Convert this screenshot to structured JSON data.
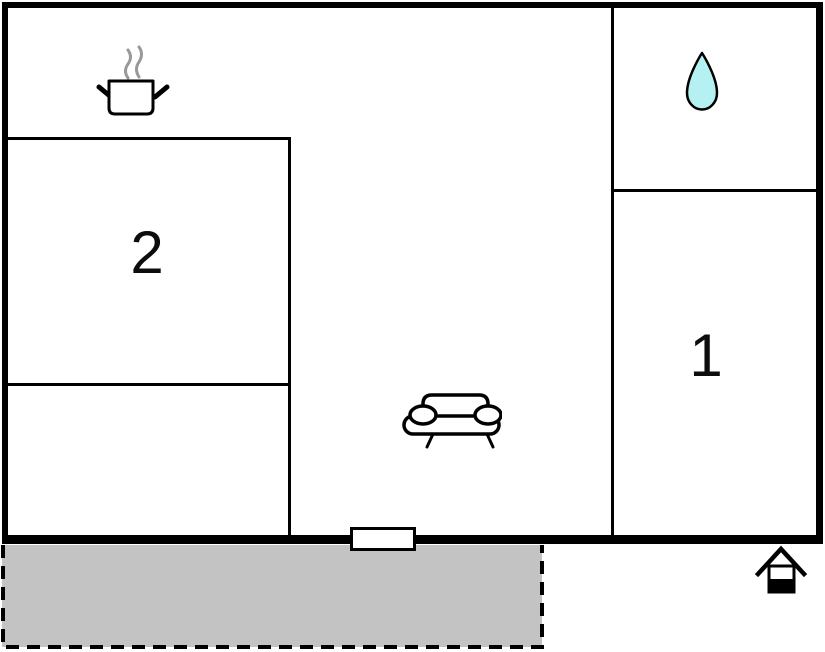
{
  "floorplan": {
    "rooms": [
      {
        "label": "1"
      },
      {
        "label": "2"
      }
    ],
    "icons": [
      "cooking-pot-icon",
      "water-drop-icon",
      "sofa-icon",
      "house-entrance-icon"
    ],
    "colors": {
      "wall": "#000000",
      "terrace_fill": "#c3c3c3",
      "water_drop_fill": "#b5f1f2",
      "steam_gray": "#999999",
      "background": "#ffffff"
    }
  }
}
